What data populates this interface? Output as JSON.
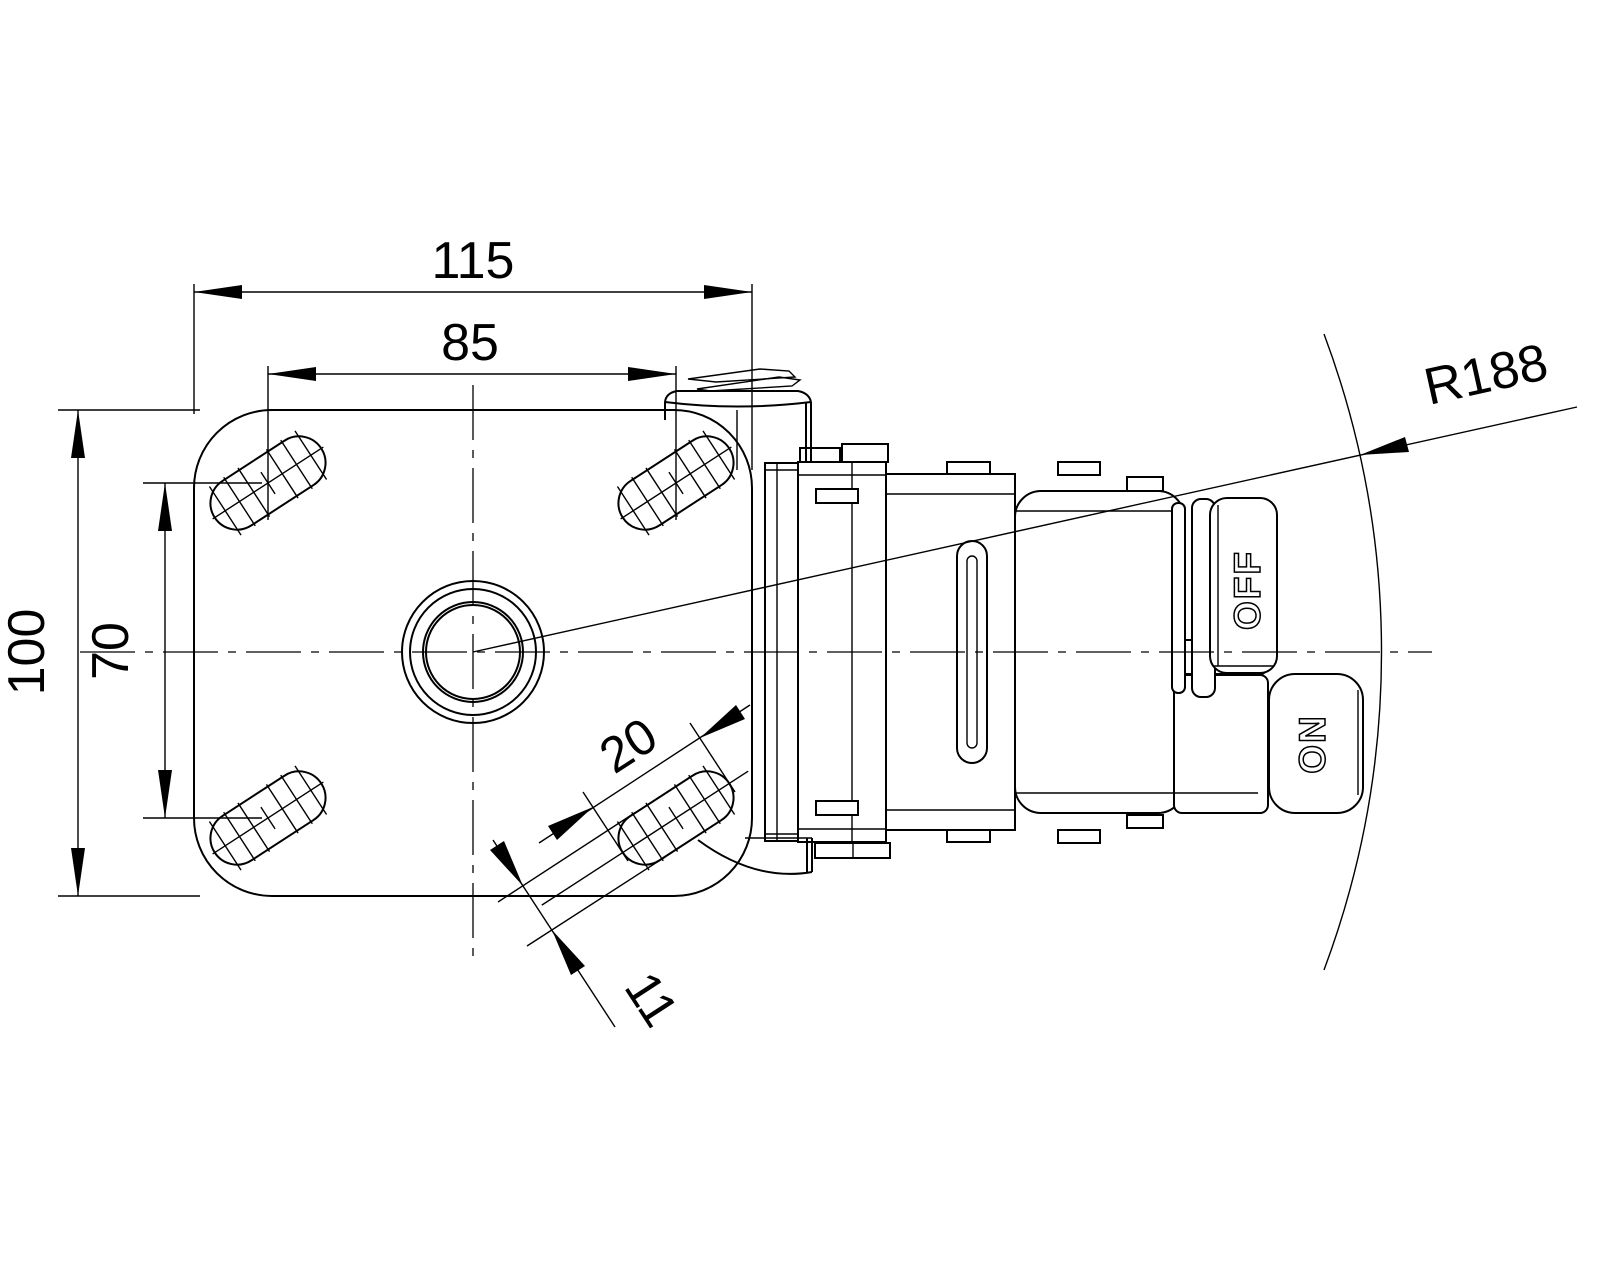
{
  "drawing": {
    "type": "caster-top-plate-technical-drawing",
    "line_color": "#000000",
    "background_color": "#ffffff",
    "dimensions": {
      "plate_width": "115",
      "bolt_spacing_width": "85",
      "plate_depth": "100",
      "bolt_spacing_depth": "70",
      "slot_length": "20",
      "slot_width": "11",
      "swivel_radius": "R188"
    },
    "pedal_labels": {
      "off": "OFF",
      "on": "ON"
    }
  }
}
